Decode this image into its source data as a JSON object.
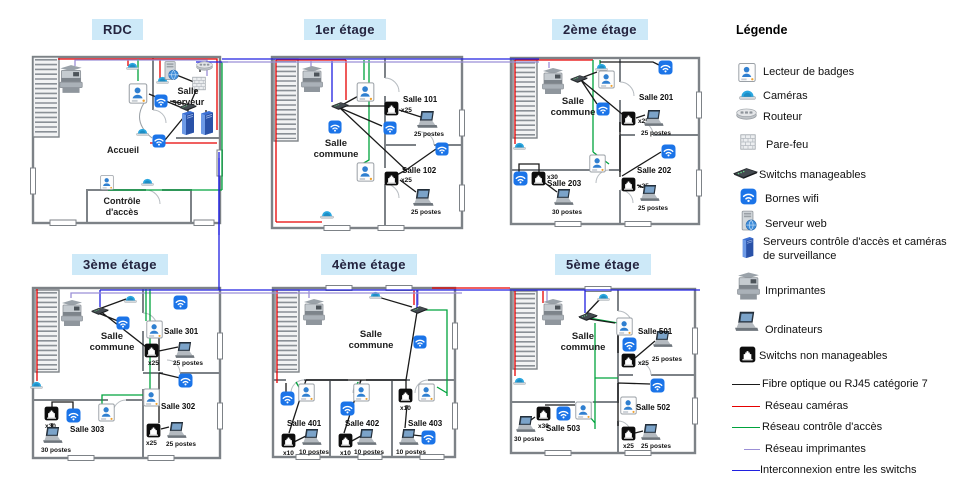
{
  "floors": [
    {
      "title": "RDC",
      "areas": {
        "server_room": "Salle serveur",
        "reception": "Accueil",
        "access_control": "Contrôle d'accès"
      }
    },
    {
      "title": "1er étage",
      "common_room": "Salle commune",
      "rooms": [
        {
          "name": "Salle 101",
          "switch_count": "x25",
          "workstations": "25 postes"
        },
        {
          "name": "Salle 102",
          "switch_count": "x25",
          "workstations": "25 postes"
        }
      ]
    },
    {
      "title": "2ème étage",
      "common_room": "Salle commune",
      "rooms": [
        {
          "name": "Salle 201",
          "switch_count": "x25",
          "workstations": "25 postes"
        },
        {
          "name": "Salle 202",
          "switch_count": "x25",
          "workstations": "25 postes"
        },
        {
          "name": "Salle 203",
          "switch_count": "x30",
          "workstations": "30 postes"
        }
      ]
    },
    {
      "title": "3ème étage",
      "common_room": "Salle commune",
      "rooms": [
        {
          "name": "Salle 301",
          "switch_count": "x25",
          "workstations": "25 postes"
        },
        {
          "name": "Salle 302",
          "switch_count": "x25",
          "workstations": "25 postes"
        },
        {
          "name": "Salle 303",
          "switch_count": "x30",
          "workstations": "30 postes"
        }
      ]
    },
    {
      "title": "4ème étage",
      "common_room": "Salle commune",
      "rooms": [
        {
          "name": "Salle 401",
          "switch_count": "x10",
          "workstations": "10 postes"
        },
        {
          "name": "Salle 402",
          "switch_count": "x10",
          "workstations": "10 postes"
        },
        {
          "name": "Salle 403",
          "switch_count": "x10",
          "workstations": "10 postes"
        }
      ]
    },
    {
      "title": "5ème étage",
      "common_room": "Salle commune",
      "rooms": [
        {
          "name": "Salle 501",
          "switch_count": "x25",
          "workstations": "25 postes"
        },
        {
          "name": "Salle 502",
          "switch_count": "x25",
          "workstations": "25 postes"
        },
        {
          "name": "Salle 503",
          "switch_count": "x30",
          "workstations": "30 postes"
        }
      ]
    }
  ],
  "legend": {
    "title": "Légende",
    "devices": [
      {
        "label": "Lecteur de badges"
      },
      {
        "label": "Caméras"
      },
      {
        "label": "Routeur"
      },
      {
        "label": "Pare-feu"
      },
      {
        "label": "Switchs manageables"
      },
      {
        "label": "Bornes wifi"
      },
      {
        "label": "Serveur web"
      },
      {
        "label": "Serveurs contrôle d'accès et caméras de surveillance"
      },
      {
        "label": "Imprimantes"
      },
      {
        "label": "Ordinateurs"
      },
      {
        "label": "Switchs non manageables"
      }
    ],
    "lines": [
      {
        "label": "Fibre optique ou RJ45 catégorie 7",
        "color": "#1a1a1a"
      },
      {
        "label": "Réseau caméras",
        "color": "#e60000"
      },
      {
        "label": "Réseau contrôle d'accès",
        "color": "#00a33d"
      },
      {
        "label": "Réseau imprimantes",
        "color": "#9b8fd6"
      },
      {
        "label": "Interconnexion entre les switchs",
        "color": "#2020e0"
      }
    ],
    "colors": {
      "wifi_blue": "#1b74e8",
      "title_chip": "#cde9f8"
    }
  }
}
